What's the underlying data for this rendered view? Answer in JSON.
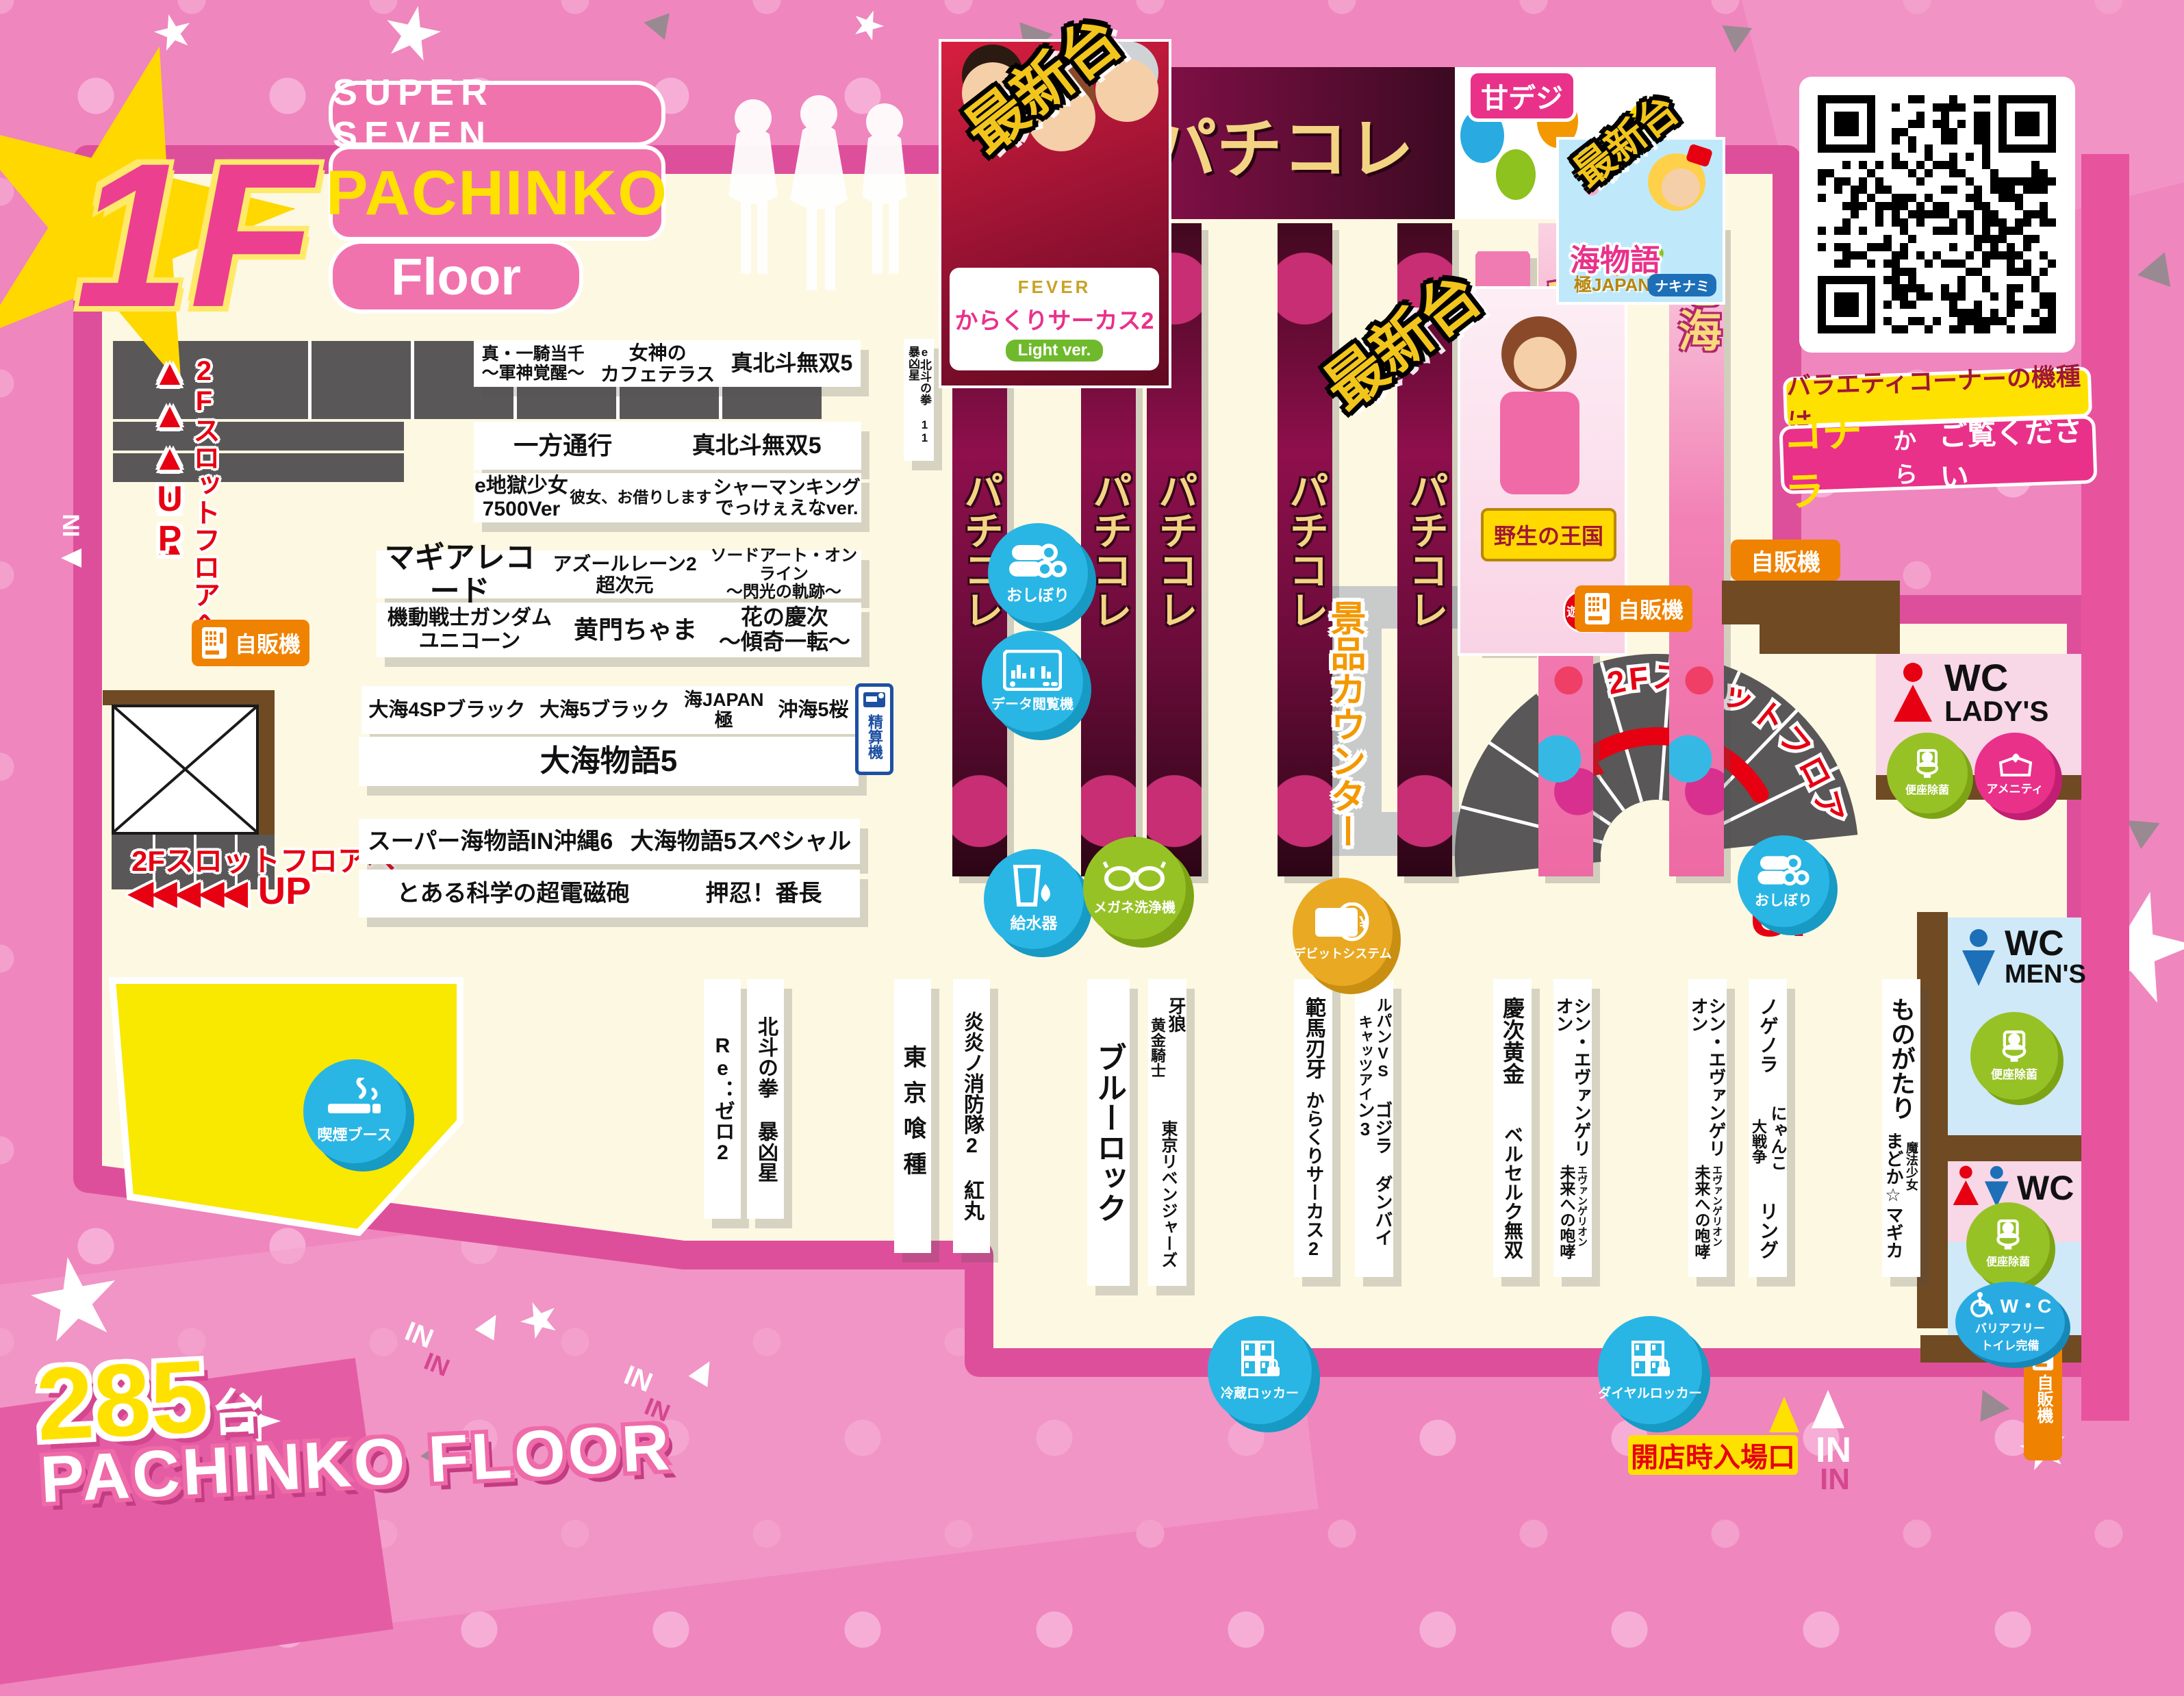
{
  "header": {
    "floor_badge": "1F",
    "brand1": "SUPER SEVEN",
    "brand2": "PACHINKO",
    "brand3": "Floor"
  },
  "footer": {
    "count": "285",
    "unit": "台",
    "label": "PACHINKO FLOOR",
    "entrance": "開店時入場口",
    "in": "IN"
  },
  "qr_panel": {
    "caption": "バラエティコーナーの機種は",
    "cta1": "コチラ",
    "cta2": "から",
    "cta3": "ご覧ください"
  },
  "banners": {
    "pachikore": "パチコレ",
    "amadeji": "甘デジ",
    "saishindai": "最新台",
    "nanami": "七海",
    "karakuri": {
      "fever": "FEVER",
      "title": "からくりサーカス2",
      "sub": "Light ver."
    },
    "yasei": {
      "title": "野生の王国",
      "badge": "遊タイム"
    },
    "umi": {
      "title": "海物語",
      "sub1": "極JAPAN",
      "sub2": "ナキナミ"
    }
  },
  "islands": {
    "a1": "真・一騎当千\n〜軍神覚醒〜",
    "a2": "女神の\nカフェテラス",
    "a3": "真北斗無双5",
    "b1": "一方通行",
    "b2": "真北斗無双5",
    "c1": "e地獄少女\n7500Ver",
    "c2": "彼女、お借りします",
    "c3": "シャーマンキング\nでっけぇえなver.",
    "d1": "マギアレコード",
    "d2": "アズールレーン2 超次元",
    "d3": "ソードアート・オンライン\n〜閃光の軌跡〜",
    "e1": "機動戦士ガンダム\nユニコーン",
    "e2": "黄門ちゃま",
    "e3": "花の慶次\n〜傾奇一転〜",
    "f1": "大海4SPブラック",
    "f2": "大海5ブラック",
    "f3": "海JAPAN\n極",
    "f4": "沖海5桜",
    "g1": "大海物語5",
    "h1": "スーパー海物語IN沖縄6",
    "h2": "大海物語5スペシャル",
    "i1": "とある科学の超電磁砲",
    "i2": "押忍！番長",
    "hokuto_e": "e北斗の拳 11 暴凶星"
  },
  "cols": {
    "c1": {
      "main": "Re：ゼロ2"
    },
    "c2": {
      "main": "北斗の拳 暴凶星"
    },
    "c3": {
      "main": "東京喰種"
    },
    "c4": {
      "main": "炎炎ノ消防隊2 紅丸"
    },
    "c5": {
      "main": "ブルーロック"
    },
    "c6": {
      "r": "牙狼",
      "l": "黄金騎士",
      "bottom": "東京リベンジャーズ"
    },
    "c7": {
      "top": "範馬刃牙",
      "bottom": "からくりサーカス2"
    },
    "c8": {
      "r": "ルパンVS",
      "l": "キャッツアイ",
      "bottom": "ゴジラ ダンバイン3"
    },
    "c9": {
      "top": "慶次黄金",
      "bottom": "ベルセルク無双"
    },
    "c10": {
      "top": "シン・エヴァンゲリオン",
      "r": "エヴァンゲリオン",
      "l": "未来への咆哮"
    },
    "c11": {
      "top": "シン・エヴァンゲリオン",
      "r": "エヴァンゲリオン",
      "l": "未来への咆哮"
    },
    "c12": {
      "top": "ノゲノラ",
      "r": "にゃんこ",
      "l": "大戦争",
      "bottom": "リング"
    },
    "c13": {
      "top": "ものがたり",
      "r": "魔法少女",
      "l": "まどか☆マギカ"
    }
  },
  "facilities": {
    "oshibori": "おしぼり",
    "data_viewer": "データ閲覧機",
    "water": "給水器",
    "glasses": "メガネ洗浄機",
    "debit": "デビットシステム",
    "smoking": "喫煙ブース",
    "fridge": "冷蔵ロッカー",
    "dial": "ダイヤルロッカー",
    "kiosk": "精算機",
    "vending": "自販機",
    "prize": "景品カウンター"
  },
  "toilets": {
    "wc": "WC",
    "ladys": "LADY'S",
    "mens": "MEN'S",
    "clean": "便座除菌",
    "amenity": "アメニティ",
    "wc2": "W・C",
    "bf1": "バリアフリー",
    "bf2": "トイレ完備"
  },
  "nav": {
    "to2f": "2Fスロットフロアへ",
    "up": "UP",
    "tri_left": "◀◀◀◀◀",
    "tri_up": "▲"
  }
}
